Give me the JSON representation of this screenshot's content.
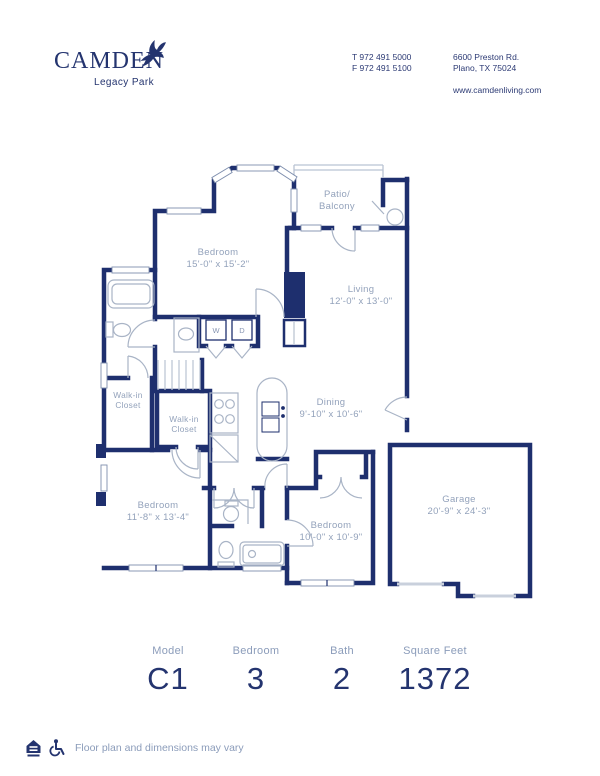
{
  "brand": {
    "name": "CAMDEN",
    "community": "Legacy Park"
  },
  "contact": {
    "phone1": "T 972 491 5000",
    "phone2": "F 972 491 5100",
    "address1": "6600 Preston Rd.",
    "address2": "Plano, TX 75024",
    "website": "www.camdenliving.com"
  },
  "floorplan": {
    "master_bedroom": {
      "name": "Bedroom",
      "dims": "15'-0\" x 15'-2\""
    },
    "living": {
      "name": "Living",
      "dims": "12'-0\" x 13'-0\""
    },
    "patio": {
      "line1": "Patio/",
      "line2": "Balcony"
    },
    "dining": {
      "name": "Dining",
      "dims": "9'-10\" x 10'-6\""
    },
    "bedroom2": {
      "name": "Bedroom",
      "dims": "11'-8\" x 13'-4\""
    },
    "bedroom3": {
      "name": "Bedroom",
      "dims": "10'-0\" x 10'-9\""
    },
    "garage": {
      "name": "Garage",
      "dims": "20'-9\" x 24'-3\""
    },
    "walkin1": {
      "line1": "Walk-in",
      "line2": "Closet"
    },
    "walkin2": {
      "line1": "Walk-in",
      "line2": "Closet"
    },
    "washer": "W",
    "dryer": "D"
  },
  "stats": [
    {
      "label": "Model",
      "value": "C1"
    },
    {
      "label": "Bedroom",
      "value": "3"
    },
    {
      "label": "Bath",
      "value": "2"
    },
    {
      "label": "Square Feet",
      "value": "1372"
    }
  ],
  "footer": {
    "disclaimer": "Floor plan and dimensions may vary"
  },
  "colors": {
    "navy": "#1e2f6e",
    "label": "#93a2bb",
    "fixture": "#a9b4c6"
  }
}
